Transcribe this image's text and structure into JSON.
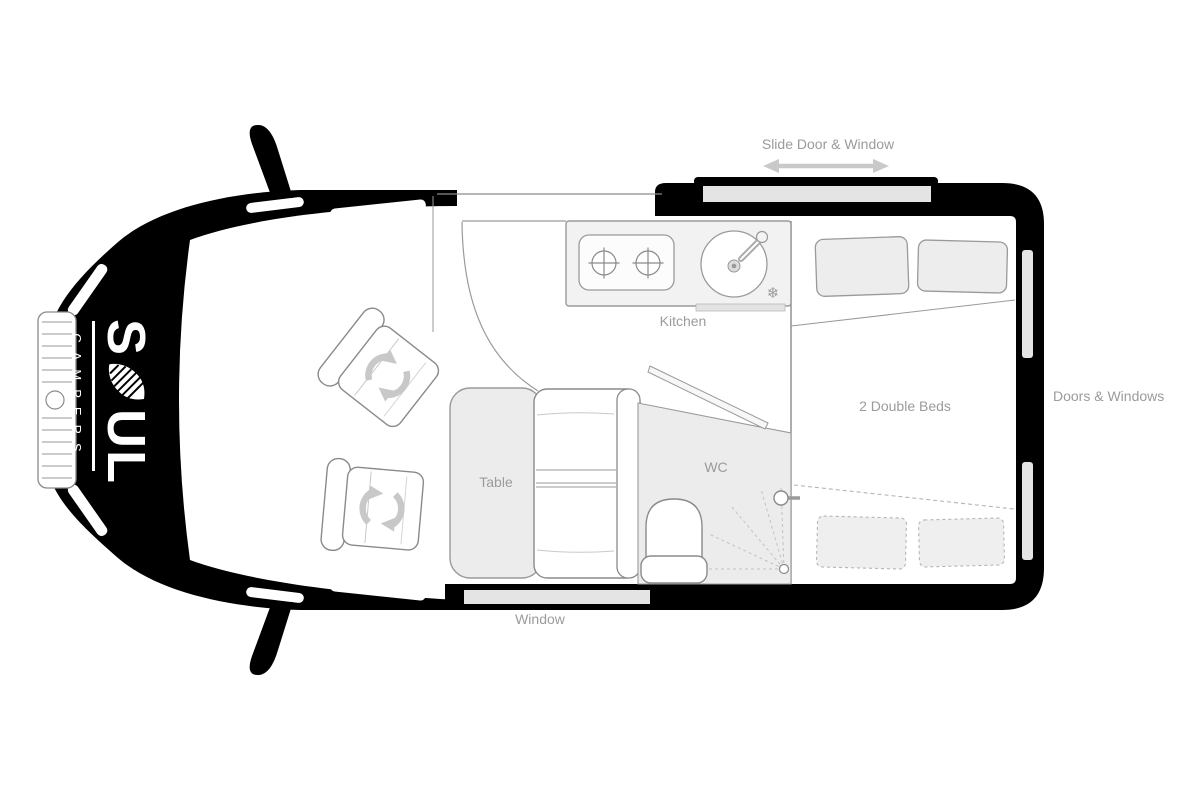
{
  "diagram": {
    "brand": {
      "wordmark": "SOUL",
      "wordmark_first": "S",
      "wordmark_rest": "UL",
      "tagline": "CAMPERS"
    },
    "labels": {
      "slide_door": "Slide Door & Window",
      "kitchen": "Kitchen",
      "beds": "2 Double Beds",
      "doors_windows": "Doors & Windows",
      "table": "Table",
      "wc": "WC",
      "window": "Window"
    },
    "icons": {
      "snowflake": "❄"
    },
    "colors": {
      "van_body": "#000000",
      "label_text": "#9b9b9b",
      "furniture_fill": "#ececec",
      "window_strip": "#e4e4e4",
      "arrow": "#c9c9c9"
    }
  }
}
